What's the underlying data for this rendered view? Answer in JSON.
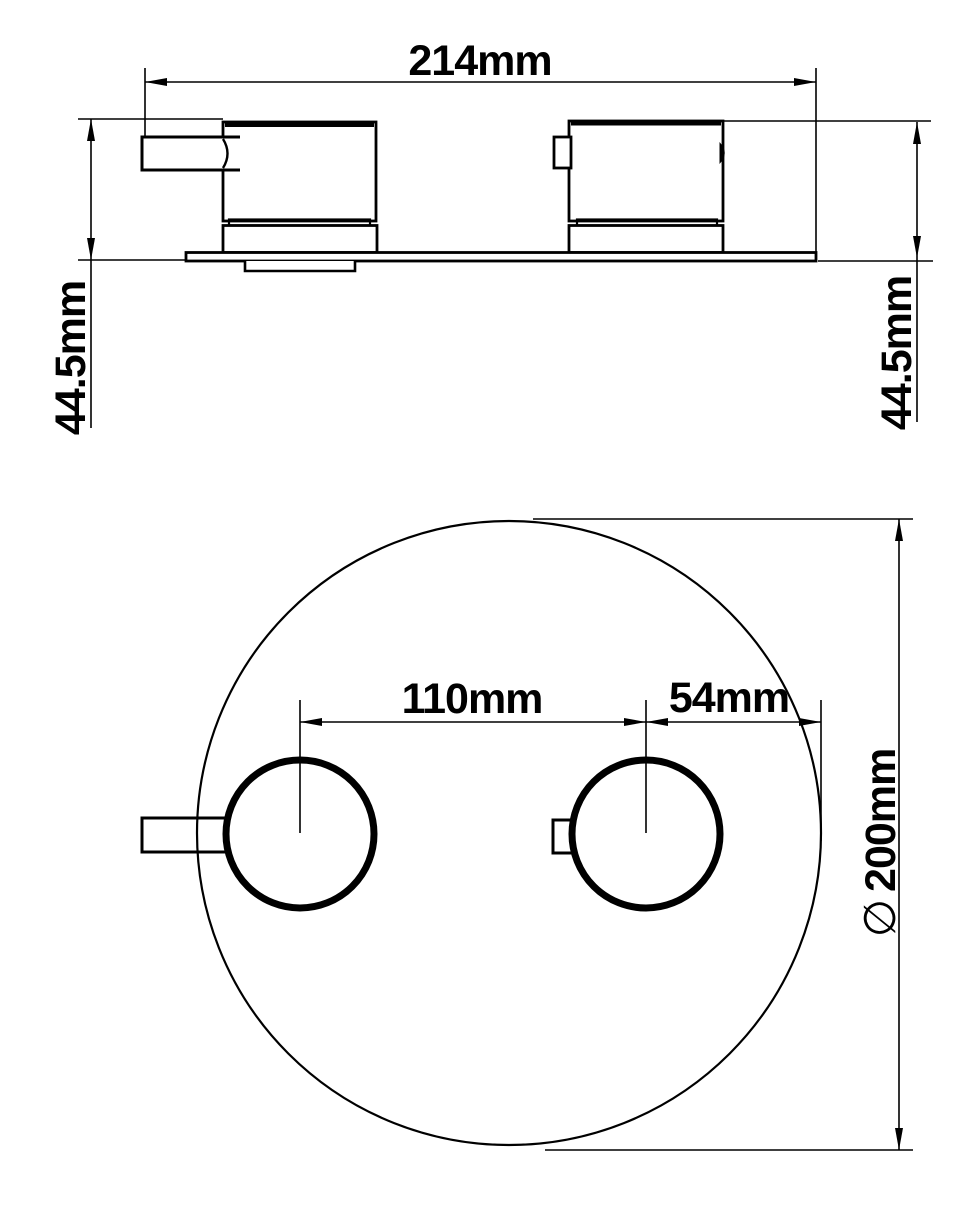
{
  "page": {
    "background": "#ffffff",
    "line_color": "#000000"
  },
  "front_view": {
    "name": "front-elevation-of-two-handle-deck-valve",
    "dims": {
      "overall_width": "214mm",
      "height_left": "44.5mm",
      "height_right": "44.5mm"
    }
  },
  "plan_view": {
    "name": "plan-view-of-round-plate",
    "dims": {
      "handle_spacing": "110mm",
      "center_to_edge": "54mm",
      "diameter_symbol": "∅",
      "plate_diameter": "200mm"
    }
  }
}
